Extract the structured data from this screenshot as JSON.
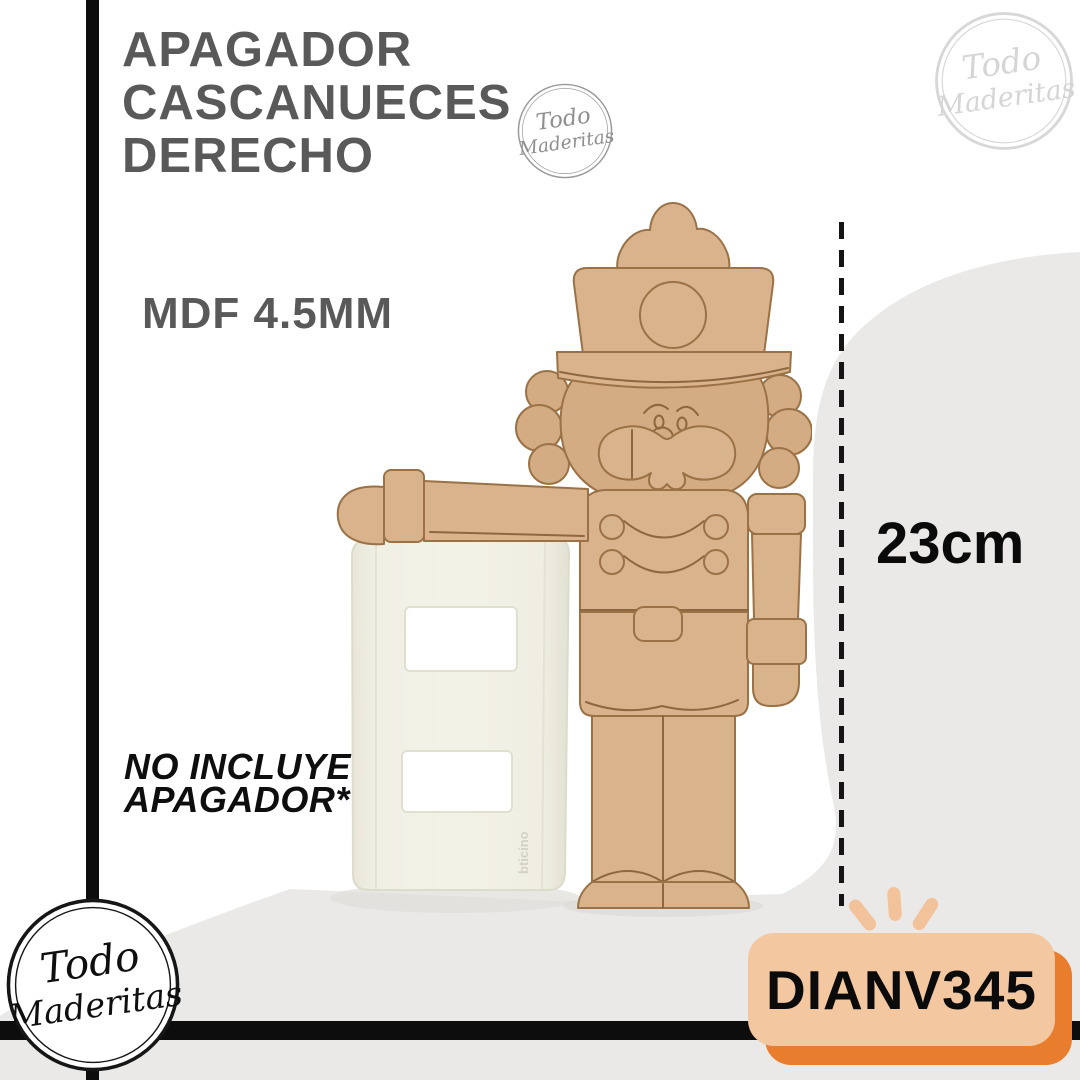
{
  "brand": {
    "line1": "Todo",
    "line2": "Maderitas"
  },
  "header": {
    "title_line1": "APAGADOR",
    "title_line2": "CASCANUECES",
    "title_line3": "DERECHO",
    "material": "MDF 4.5MM"
  },
  "measurement": {
    "height": "23cm"
  },
  "disclaimer": {
    "line1": "NO INCLUYE",
    "line2": "APAGADOR*"
  },
  "sku": {
    "code": "DIANV345"
  },
  "photo": {
    "plate_brand": "bticino"
  },
  "colors": {
    "title_gray": "#595959",
    "frame_black": "#0d0d0d",
    "badge_peach": "#f3c7a0",
    "badge_orange": "#e87e2d",
    "ray_peach": "#f2c29a",
    "wood_tan": "#d8b38c",
    "wood_outline": "#9b7146",
    "background_gray": "#eae9e8",
    "plate_cream": "#f0efe4"
  }
}
